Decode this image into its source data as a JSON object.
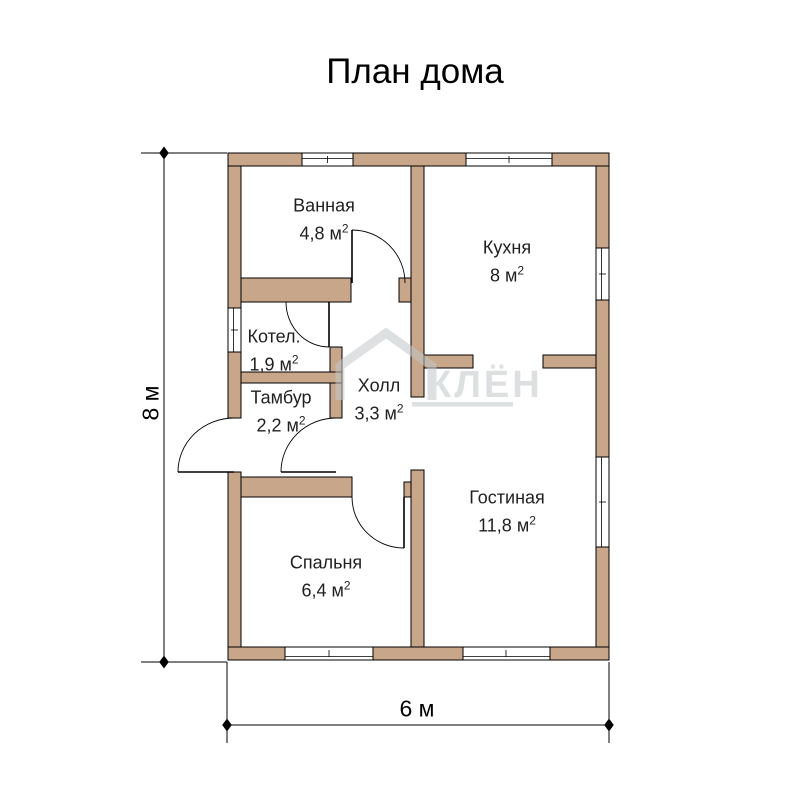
{
  "title": "План дома",
  "watermark": {
    "text": "КЛЁН"
  },
  "dimensions": {
    "height_label": "8 м",
    "width_label": "6 м"
  },
  "units": {
    "area_unit": "м",
    "sup": "2"
  },
  "rooms": [
    {
      "name": "Ванная",
      "area": "4,8"
    },
    {
      "name": "Кухня",
      "area": "8"
    },
    {
      "name": "Котел.",
      "area": "1,9"
    },
    {
      "name": "Тамбур",
      "area": "2,2"
    },
    {
      "name": "Холл",
      "area": "3,3"
    },
    {
      "name": "Гостиная",
      "area": "11,8"
    },
    {
      "name": "Спальня",
      "area": "6,4"
    }
  ],
  "colors": {
    "wall_fill": "#c7a689",
    "outline": "#000000",
    "watermark": "#c3c7ca",
    "background": "#ffffff"
  }
}
